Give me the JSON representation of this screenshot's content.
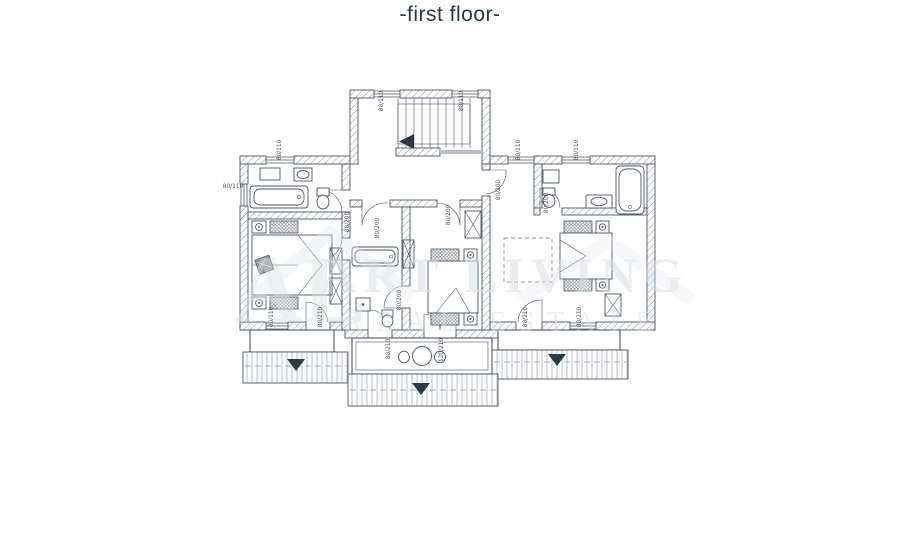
{
  "title": "-first floor-",
  "watermark": {
    "line1": "ART LIVING",
    "line2": "REAL ESTATE",
    "monogram": "AL"
  },
  "dimension_labels": [
    {
      "text": "80/110",
      "x": 383,
      "y": 101,
      "rot": -90
    },
    {
      "text": "80/110",
      "x": 463,
      "y": 101,
      "rot": -90
    },
    {
      "text": "80/110",
      "x": 281,
      "y": 150,
      "rot": -90
    },
    {
      "text": "80/110",
      "x": 520,
      "y": 150,
      "rot": -90
    },
    {
      "text": "80/110",
      "x": 578,
      "y": 150,
      "rot": -90
    },
    {
      "text": "80/110",
      "x": 233,
      "y": 188,
      "rot": 0
    },
    {
      "text": "80/200",
      "x": 349,
      "y": 222,
      "rot": -90
    },
    {
      "text": "80/200",
      "x": 379,
      "y": 228,
      "rot": -90
    },
    {
      "text": "80/200",
      "x": 450,
      "y": 215,
      "rot": -90
    },
    {
      "text": "80/200",
      "x": 500,
      "y": 190,
      "rot": -90
    },
    {
      "text": "80/200",
      "x": 548,
      "y": 203,
      "rot": -90
    },
    {
      "text": "80/200",
      "x": 401,
      "y": 300,
      "rot": -90
    },
    {
      "text": "80/110",
      "x": 273,
      "y": 317,
      "rot": -90
    },
    {
      "text": "80/210",
      "x": 322,
      "y": 317,
      "rot": -90
    },
    {
      "text": "80/210",
      "x": 390,
      "y": 349,
      "rot": -90
    },
    {
      "text": "120/210",
      "x": 443,
      "y": 350,
      "rot": -90
    },
    {
      "text": "80/210",
      "x": 527,
      "y": 317,
      "rot": -90
    },
    {
      "text": "80/210",
      "x": 581,
      "y": 317,
      "rot": -90
    }
  ],
  "colors": {
    "ink": "#2b3840",
    "line": "#4d575f",
    "lineLight": "#8d969c",
    "dark": "#2c3a45",
    "wm": "#d9dfe2"
  }
}
